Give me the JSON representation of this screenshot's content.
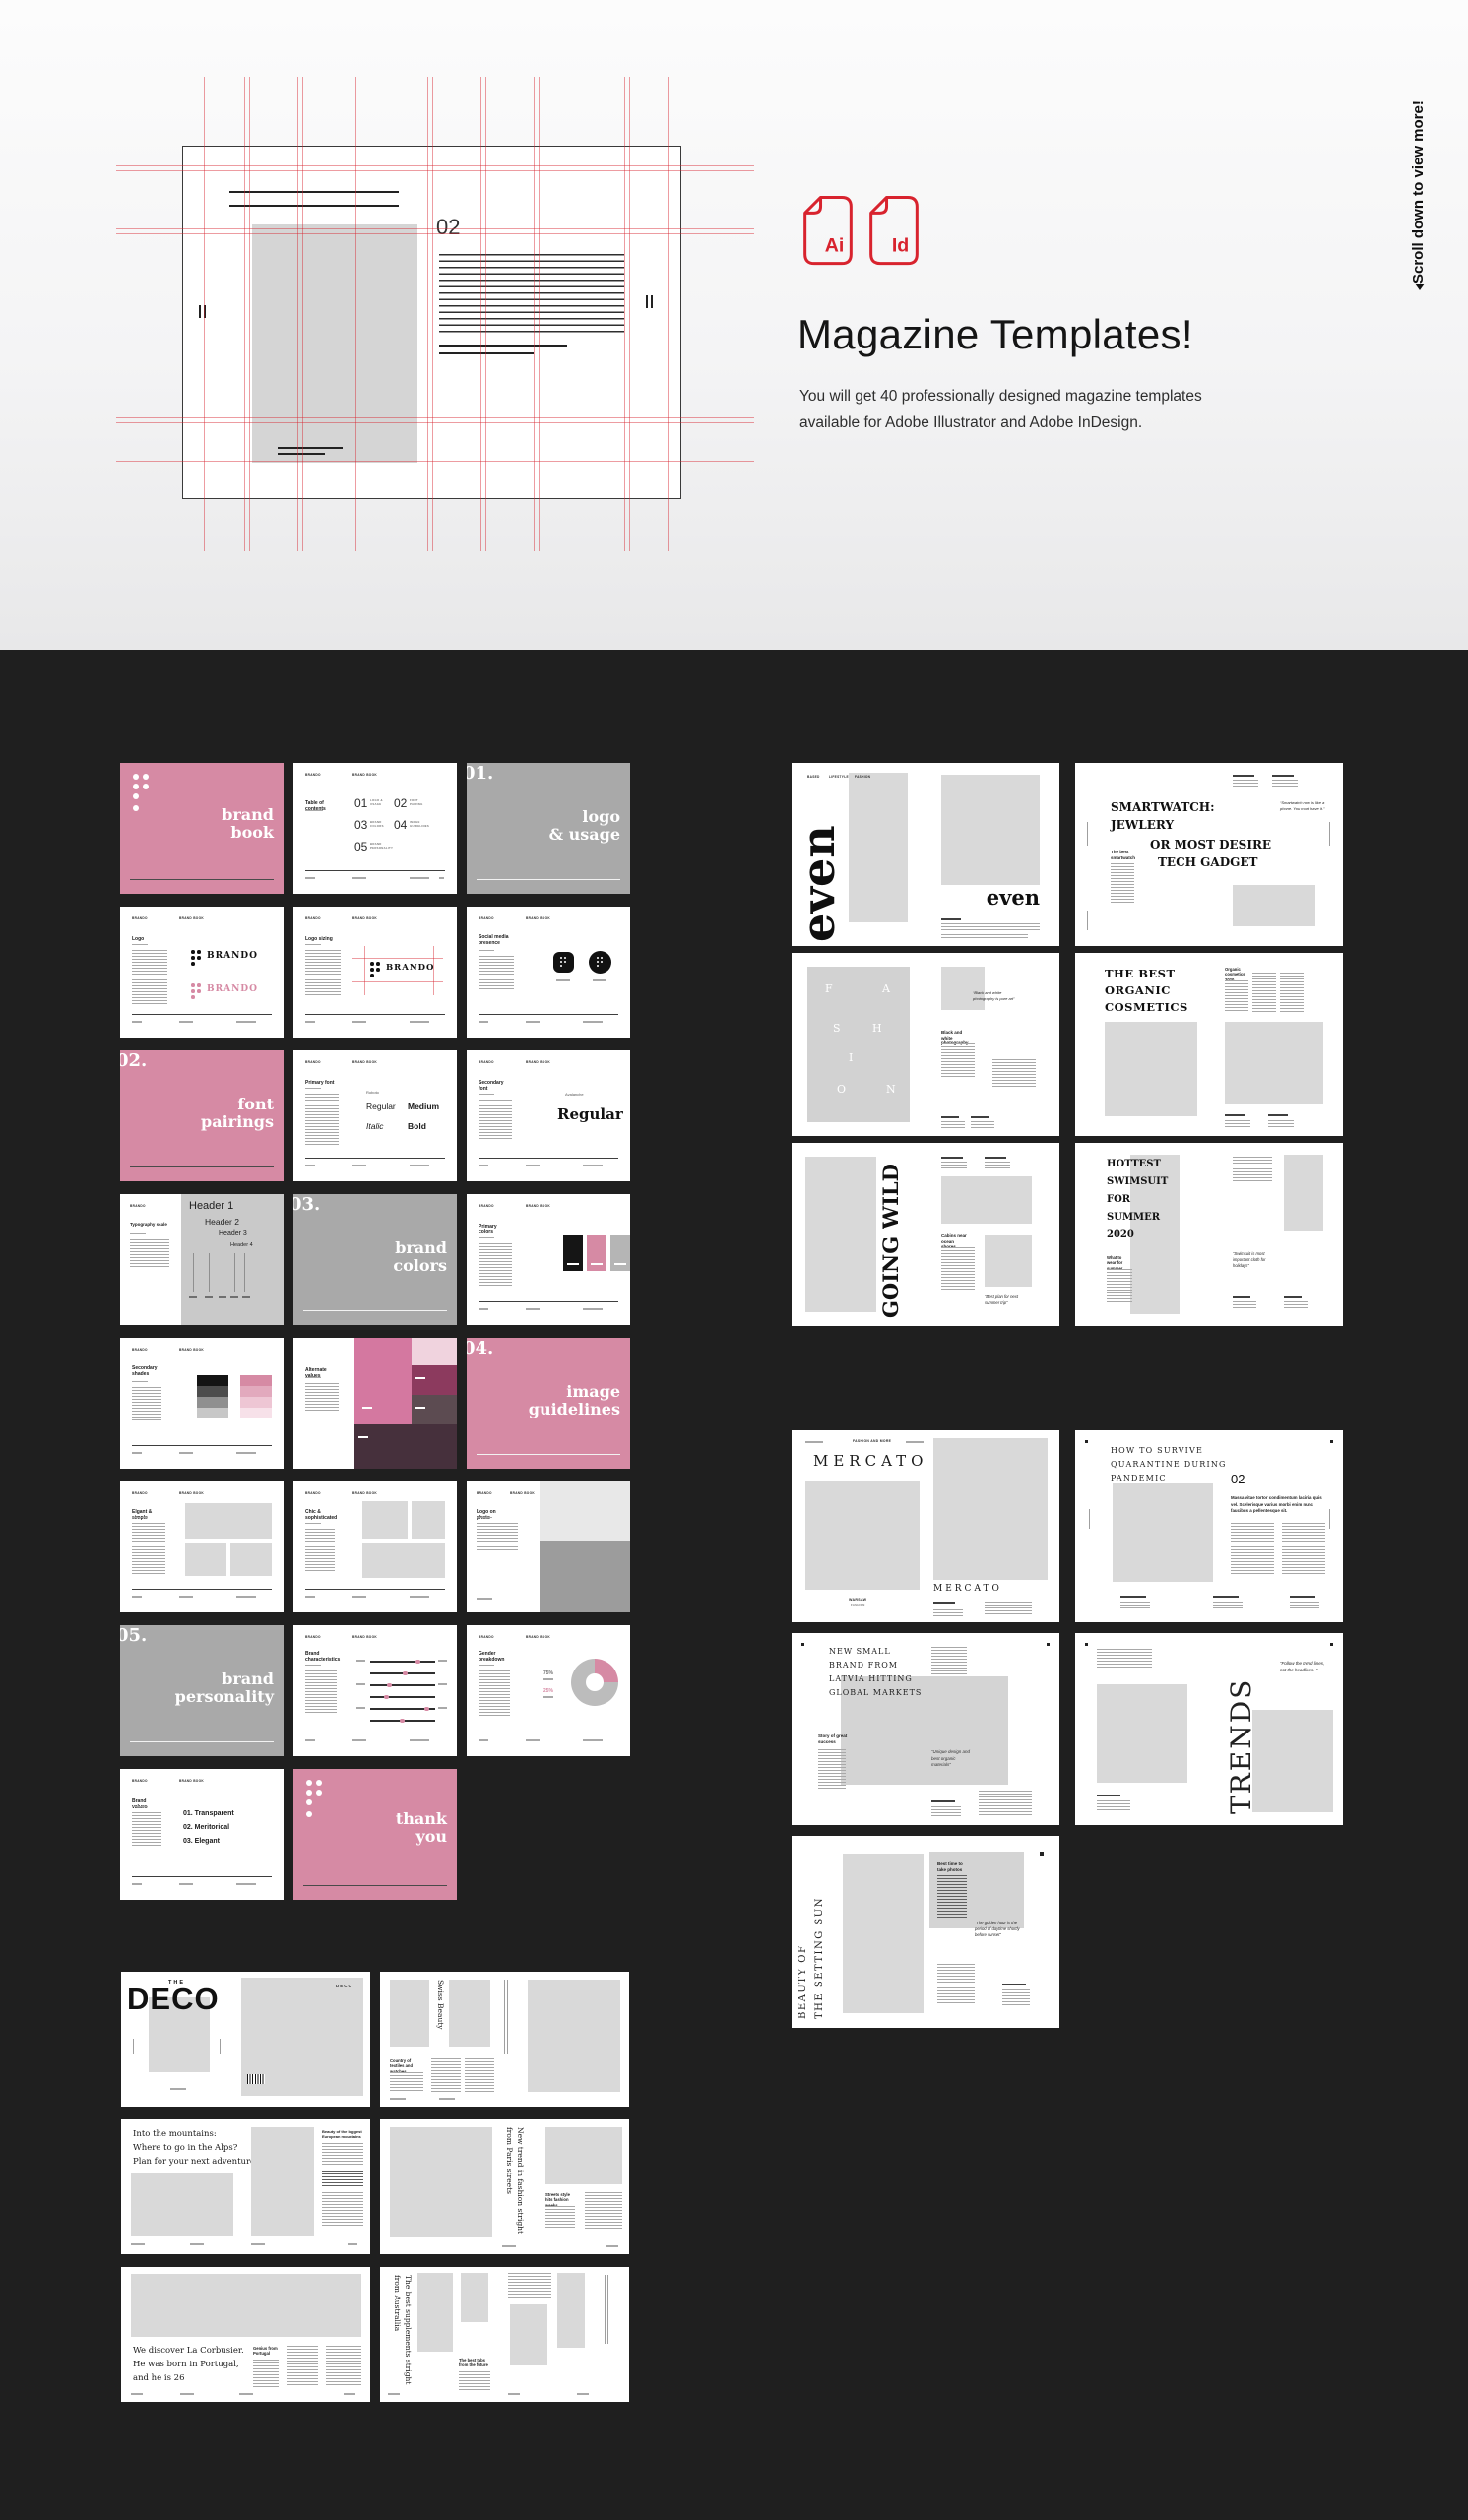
{
  "hero": {
    "title": "Magazine Templates!",
    "desc1": "You will get 40 professionally designed magazine templates",
    "desc2": "available for Adobe Illustrator and Adobe InDesign.",
    "icon1": "Ai",
    "icon2": "Id",
    "scroll_hint": "Scroll down to view more!",
    "preview_page_num": "02"
  },
  "colors": {
    "accent_red": "#d8232e",
    "pink": "#d68aa4",
    "chapter_gray": "#a9a9a9",
    "placeholder_gray": "#d9d9d9",
    "dark_bg": "#1f1f1f"
  },
  "bb": {
    "brand": "BRANDO",
    "doc": "BRAND BOOK",
    "cover": {
      "l1": "brand",
      "l2": "book"
    },
    "toc": {
      "title": "Table of contents",
      "n1": "01",
      "t1": "LOGO & USAGE",
      "n2": "02",
      "t2": "FONT PAIRING",
      "n3": "03",
      "t3": "BRAND COLORS",
      "n4": "04",
      "t4": "IMAGE GUIDELINES",
      "n5": "05",
      "t5": "BRAND PERSONALITY"
    },
    "ch1": {
      "num": "01.",
      "l1": "logo",
      "l2": "& usage"
    },
    "logo": {
      "title": "Logo",
      "brand1": "BRANDO",
      "brand2": "BRANDO"
    },
    "sizing": {
      "title": "Logo sizing",
      "brand": "BRANDO"
    },
    "social": {
      "title": "Social media presence"
    },
    "ch2": {
      "num": "02.",
      "l1": "font",
      "l2": "pairings"
    },
    "primary": {
      "title": "Primary font",
      "font": "Roboto",
      "w1": "Regular",
      "w2": "Medium",
      "w3": "Italic",
      "w4": "Bold"
    },
    "secondary": {
      "title": "Secondary font",
      "font": "Avalanche",
      "sample": "Regular"
    },
    "typescale": {
      "title": "Typography scale",
      "h1": "Header 1",
      "h2": "Header 2",
      "h3": "Header 3",
      "h4": "Header 4"
    },
    "ch3": {
      "num": "03.",
      "l1": "brand",
      "l2": "colors"
    },
    "pcolors": {
      "title": "Primary colors"
    },
    "shades": {
      "title": "Secondary shades"
    },
    "alt": {
      "title": "Alternate values"
    },
    "ch4": {
      "num": "04.",
      "l1": "image",
      "l2": "guidelines"
    },
    "elegant": {
      "title": "Elgant & simple"
    },
    "chic": {
      "title": "Chic & sophisticated"
    },
    "logophoto": {
      "title": "Logo on photo"
    },
    "ch5": {
      "num": "05.",
      "l1": "brand",
      "l2": "personality"
    },
    "chars": {
      "title": "Brand characteristics"
    },
    "gender": {
      "title": "Gender breakdown",
      "v1": "75%",
      "v2": "25%"
    },
    "values": {
      "title": "Brand values",
      "i1": "01. Transparent",
      "i2": "02. Meritorical",
      "i3": "03. Elegant"
    },
    "thanks": {
      "l1": "thank",
      "l2": "you"
    }
  },
  "mag": {
    "even": {
      "tag1": "BASED",
      "tag2": "LIFESTYLE",
      "tag3": "FASHION",
      "masthead": "even",
      "title2": "even"
    },
    "smartwatch": {
      "l1": "SMARTWATCH:",
      "l2": "JEWLERY",
      "l3": "OR MOST DESIRE",
      "l4": "TECH GADGET",
      "quote": "“Smartwatch now is like a phone. You must have it.”",
      "side": "The best smartwatch"
    },
    "fashion": {
      "f1": "F",
      "f2": "A",
      "f3": "S",
      "f4": "H",
      "f5": "I",
      "f6": "O",
      "f7": "N",
      "quote": "“Black and white photography is pure art”",
      "head": "Black and white photography"
    },
    "cosmetics": {
      "l1": "THE BEST",
      "l2": "ORGANIC",
      "l3": "COSMETICS",
      "head": "Organic cosmetics 2020"
    },
    "wild": {
      "title": "GOING WILD",
      "head": "Cabins near ocean shores",
      "quote": "“Best plan for next summer trip”"
    },
    "swim": {
      "l1": "HOTTEST",
      "l2": "SWIMSUIT",
      "l3": "FOR",
      "l4": "SUMMER",
      "l5": "2020",
      "head": "What to wear for summer",
      "quote": "“Swimsuit is most important cloth for holidays”"
    },
    "mercato": {
      "tag": "FASHION AND MORE",
      "masthead": "MERCATO",
      "title2": "MERCATO",
      "city": "WARSAW",
      "city2": "FASHION"
    },
    "quarantine": {
      "l1": "HOW TO SURVIVE",
      "l2": "QUARANTINE DURING",
      "l3": "PANDEMIC",
      "num": "02",
      "intro": "Massa vitae tortor condimentum lacinia quis vel. Scelerisque varius morbi enim nunc faucibus a pellentesque sit."
    },
    "latvia": {
      "l1": "NEW SMALL",
      "l2": "BRAND FROM",
      "l3": "LATVIA HITTING",
      "l4": "GLOBAL MARKETS",
      "head": "Story of great success",
      "quote": "“Unique design and best organic materials”"
    },
    "trends": {
      "title": "TRENDS",
      "quote": "“Follow the trend lines, not the headlines. ”"
    },
    "sunset": {
      "v1": "BEAUTY OF",
      "v2": "THE SETTING SUN",
      "head": "Best time to take photos",
      "quote": "“The golden hour is the period of daytime shortly before sunset”"
    }
  },
  "deco": {
    "cover": {
      "kicker": "THE",
      "title": "DECO",
      "label": "DECO"
    },
    "swiss": {
      "title": "Swiss Beauty",
      "head": "Country of textiles and watches"
    },
    "alps": {
      "l1": "Into the mountains:",
      "l2": "Where to go in the Alps?",
      "l3": "Plan for your next adventure.",
      "head": "Beauty of the biggest European mountains"
    },
    "paris": {
      "title": "New trend in fashion stright from Paris streets",
      "head": "Streets style hits fashion weeks"
    },
    "corb": {
      "l1": "We discover La Corbusier.",
      "l2": "He was born in Portugal,",
      "l3": "and he is 26",
      "head": "Genius from Portugal"
    },
    "aus": {
      "title": "The best supplements stright from Australlia",
      "head": "The best tabs from the future"
    }
  }
}
